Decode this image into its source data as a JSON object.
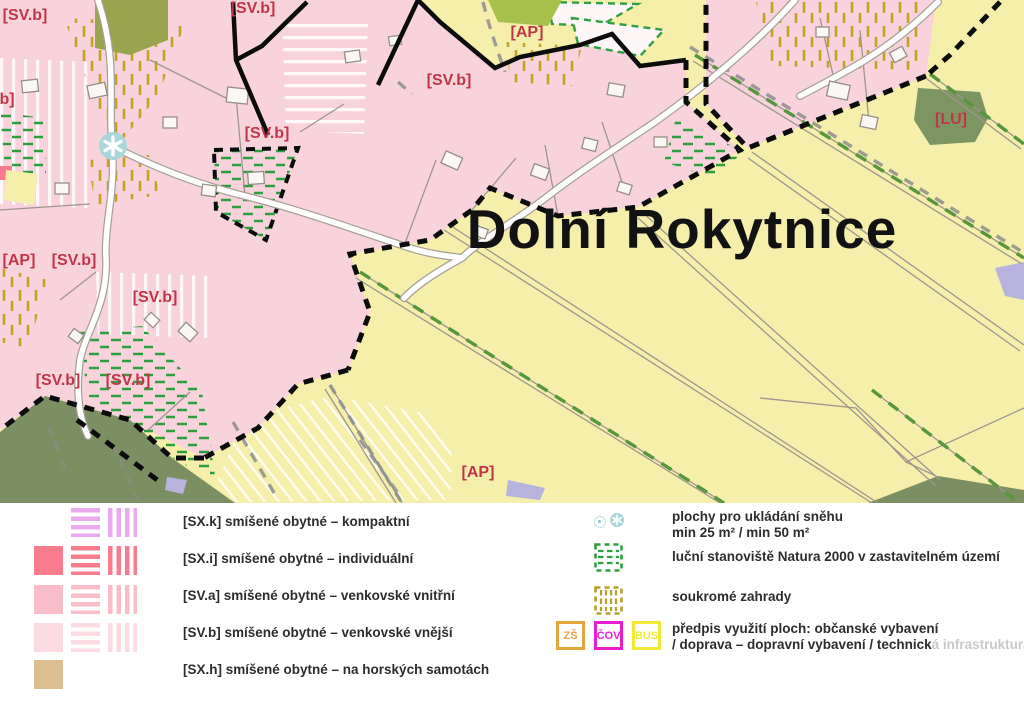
{
  "map": {
    "title": "Dolní Rokytnice",
    "zone_labels": [
      {
        "text": "[SV.b]",
        "x": 25,
        "y": 20
      },
      {
        "text": "[SV.b]",
        "x": 253,
        "y": 13
      },
      {
        "text": "[AP]",
        "x": 527,
        "y": 37
      },
      {
        "text": "[SV.b]",
        "x": 449,
        "y": 85
      },
      {
        "text": "[SV.b]",
        "x": 267,
        "y": 138
      },
      {
        "text": "[LU]",
        "x": 951,
        "y": 124
      },
      {
        "text": "b]",
        "x": 7,
        "y": 104
      },
      {
        "text": "[AP]",
        "x": 19,
        "y": 265
      },
      {
        "text": "[SV.b]",
        "x": 74,
        "y": 265
      },
      {
        "text": "[SV.b]",
        "x": 155,
        "y": 302
      },
      {
        "text": "[SV.b]",
        "x": 58,
        "y": 385
      },
      {
        "text": "[SV.b]",
        "x": 128,
        "y": 385
      },
      {
        "text": "[AP]",
        "x": 478,
        "y": 477
      }
    ],
    "snow_marker": "snowflake-asterisk",
    "colors": {
      "residential_pink": "#f8d3dc",
      "field_yellow": "#f6eeab",
      "forest_green": "#7b8f63",
      "lu_green": "#7d9463",
      "garden_hatch_olive": "#c3a324",
      "natura_hatch_green": "#2f9e41",
      "label_red": "#bf3648",
      "boundary_black": "#0c0c0c",
      "snow_teal": "#a9d6da"
    }
  },
  "legend": {
    "left": [
      {
        "label": "[SX.k] smíšené obytné – kompaktní",
        "color": "#eba9f0",
        "variants": [
          "h",
          "v"
        ]
      },
      {
        "label": "[SX.i] smíšené obytné – individuální",
        "color": "#f97c8e",
        "variants": [
          "solid",
          "h",
          "v"
        ]
      },
      {
        "label": "[SV.a] smíšené obytné – venkovské vnitřní",
        "color": "#f9bdca",
        "variants": [
          "solid",
          "h",
          "v"
        ]
      },
      {
        "label": "[SV.b] smíšené obytné – venkovské vnější",
        "color": "#fcdbe2",
        "variants": [
          "solid",
          "h",
          "v"
        ]
      },
      {
        "label": "[SX.h] smíšené obytné – na horských samotách",
        "color": "#ddbe93",
        "variants": [
          "solid"
        ]
      }
    ],
    "right": {
      "snow": {
        "line1": "plochy pro ukládání sněhu",
        "line2": "min 25 m² / min 50 m²",
        "color": "#9fd0d6"
      },
      "natura": {
        "label": "luční stanoviště Natura 2000 v zastavitelném území",
        "color": "#2f9e41"
      },
      "gardens": {
        "label": "soukromé zahrady",
        "color": "#b4a02b"
      },
      "usage": {
        "line1": "předpis využití ploch: občanské vybavení",
        "line2_main": "/ doprava – dopravní vybavení / technick",
        "line2_faded": "á infrastruktura",
        "boxes": [
          {
            "text": "ZŠ",
            "color": "#e5a53d"
          },
          {
            "text": "ČOV",
            "color": "#e81dd1"
          },
          {
            "text": "BUS",
            "color": "#f2e838"
          }
        ]
      }
    }
  }
}
